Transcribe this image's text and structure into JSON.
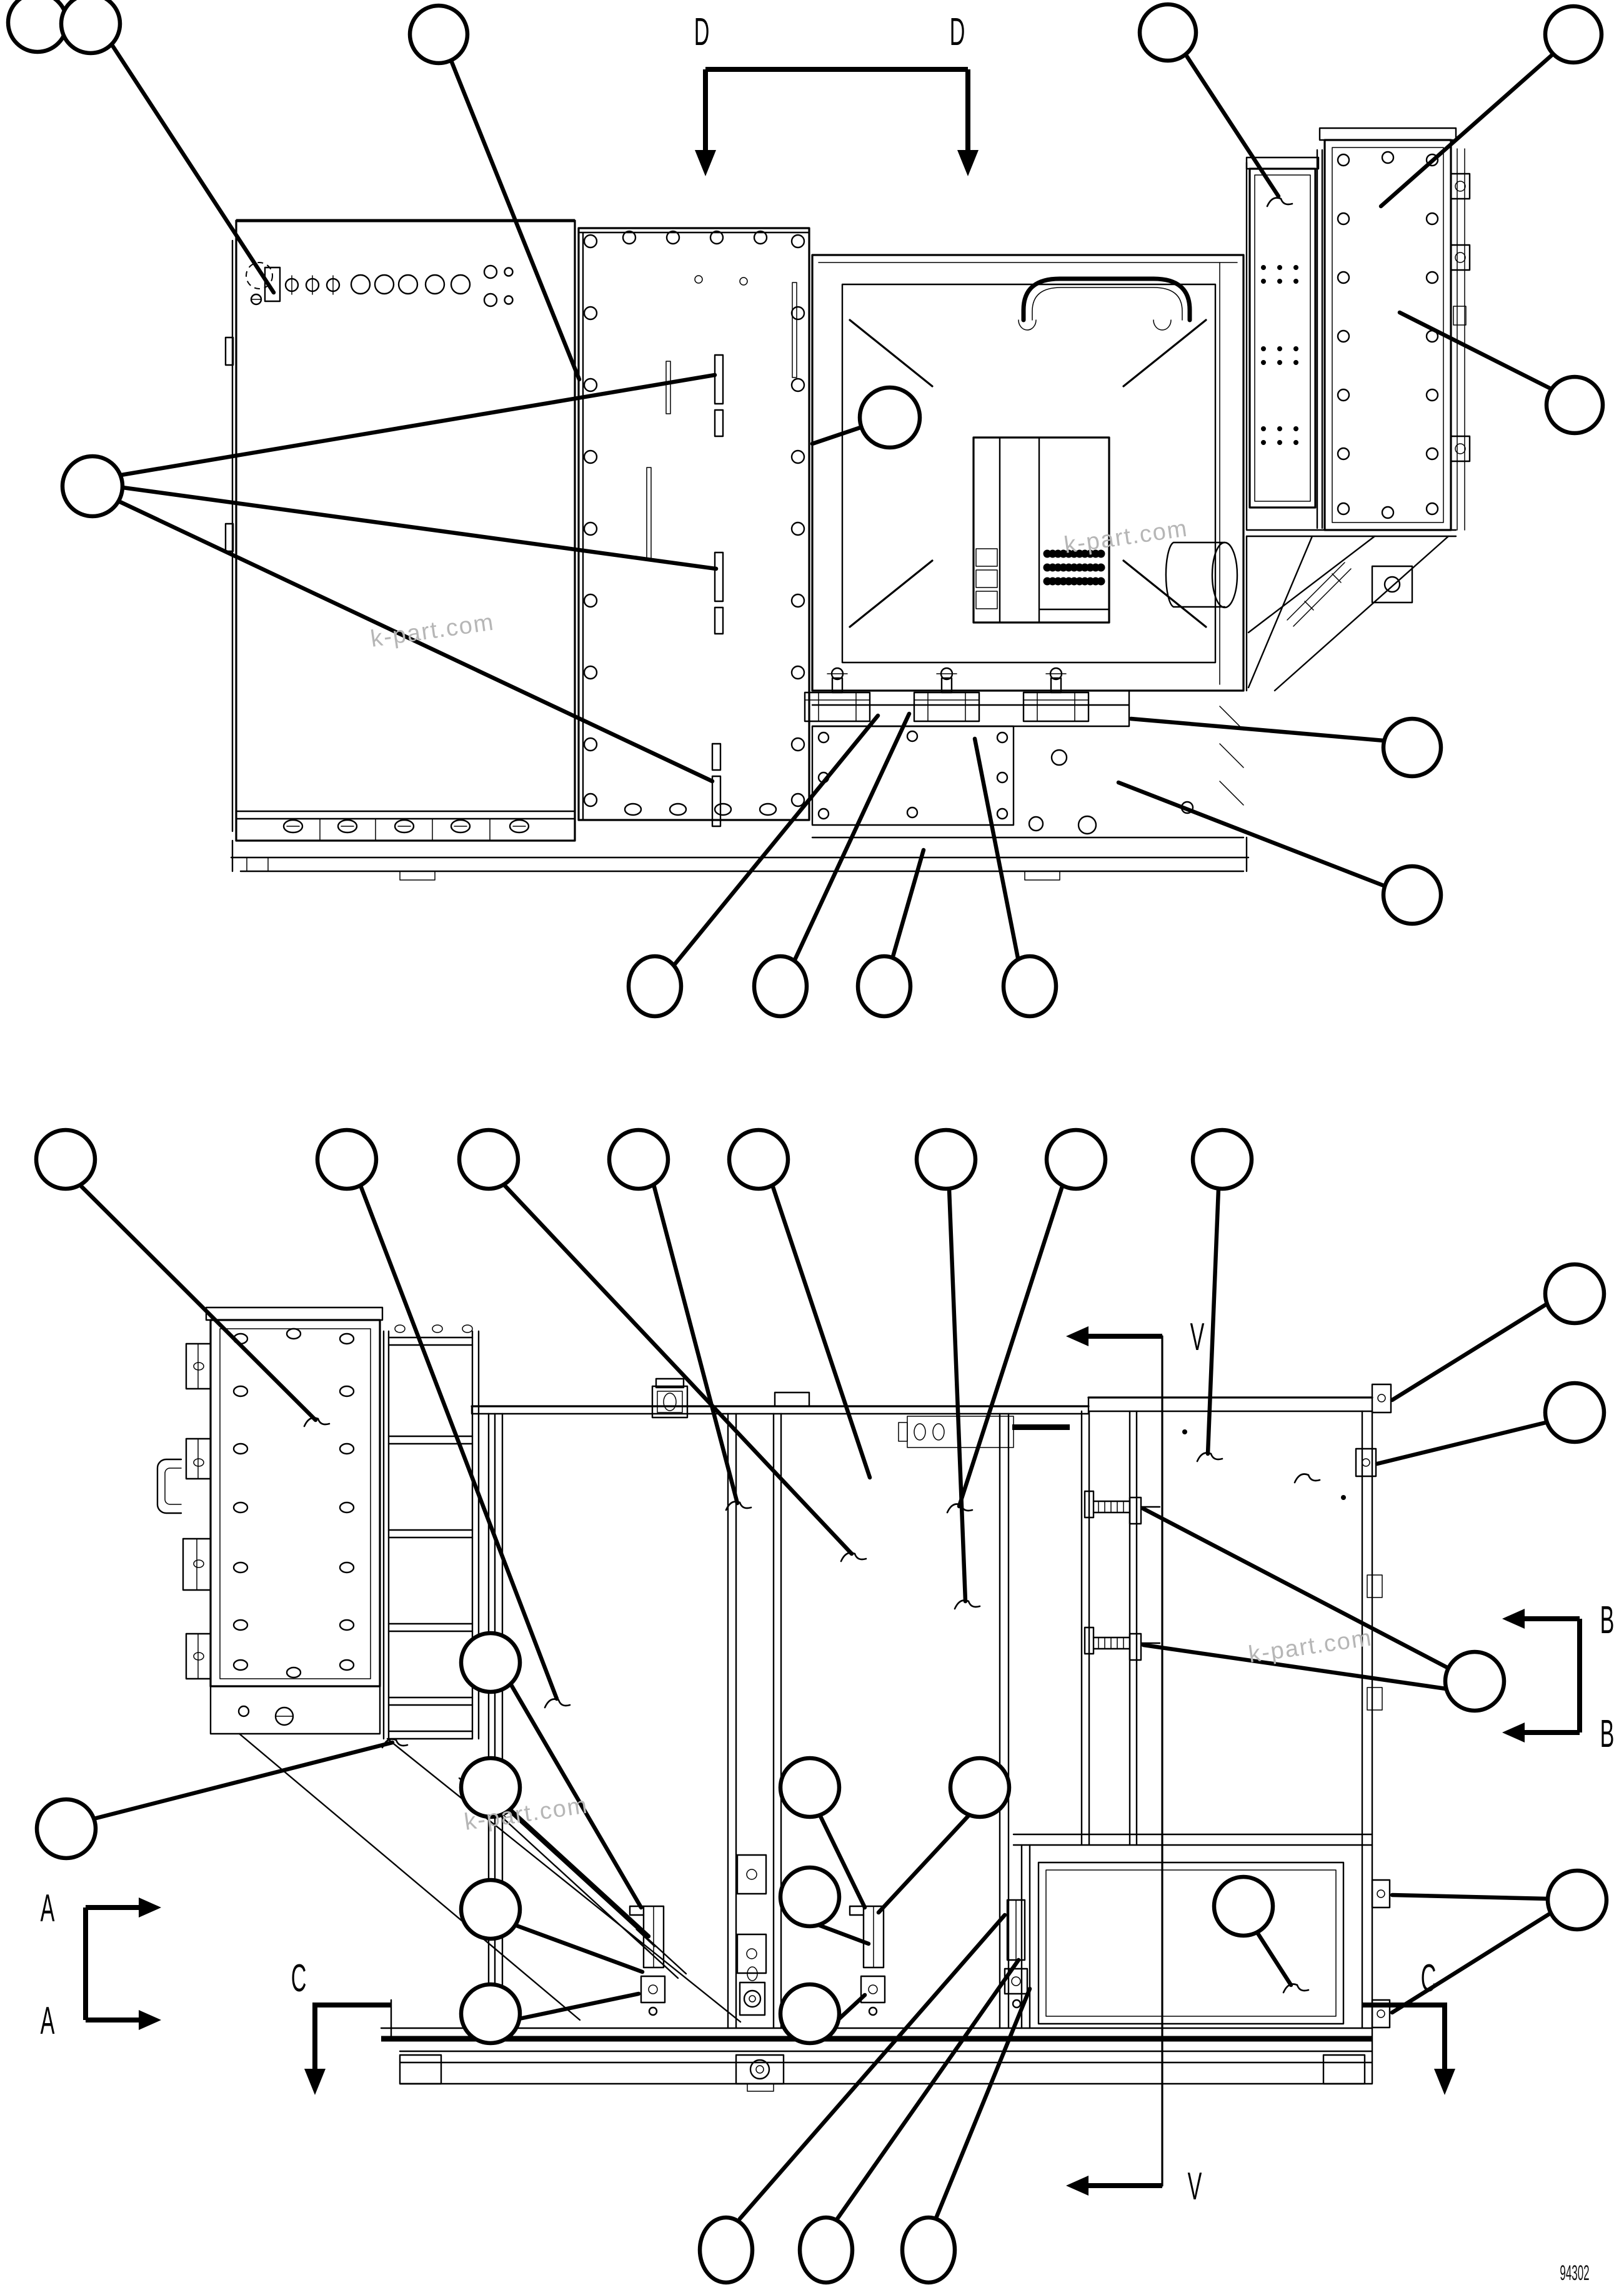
{
  "page": {
    "background": "#ffffff",
    "line_color": "#000000",
    "watermark_color": "#b6b6b6"
  },
  "drawing": {
    "part_number": "94302",
    "watermarks": [
      "k-part.com",
      "k-part.com",
      "k-part.com",
      "k-part.com"
    ],
    "section_markers": {
      "d_left": "D",
      "d_right": "D",
      "v_top": "V",
      "v_bottom": "V",
      "b_upper": "B",
      "b_lower": "B",
      "a_upper": "A",
      "a_lower": "A",
      "c_left": "C",
      "c_right": "C"
    }
  }
}
